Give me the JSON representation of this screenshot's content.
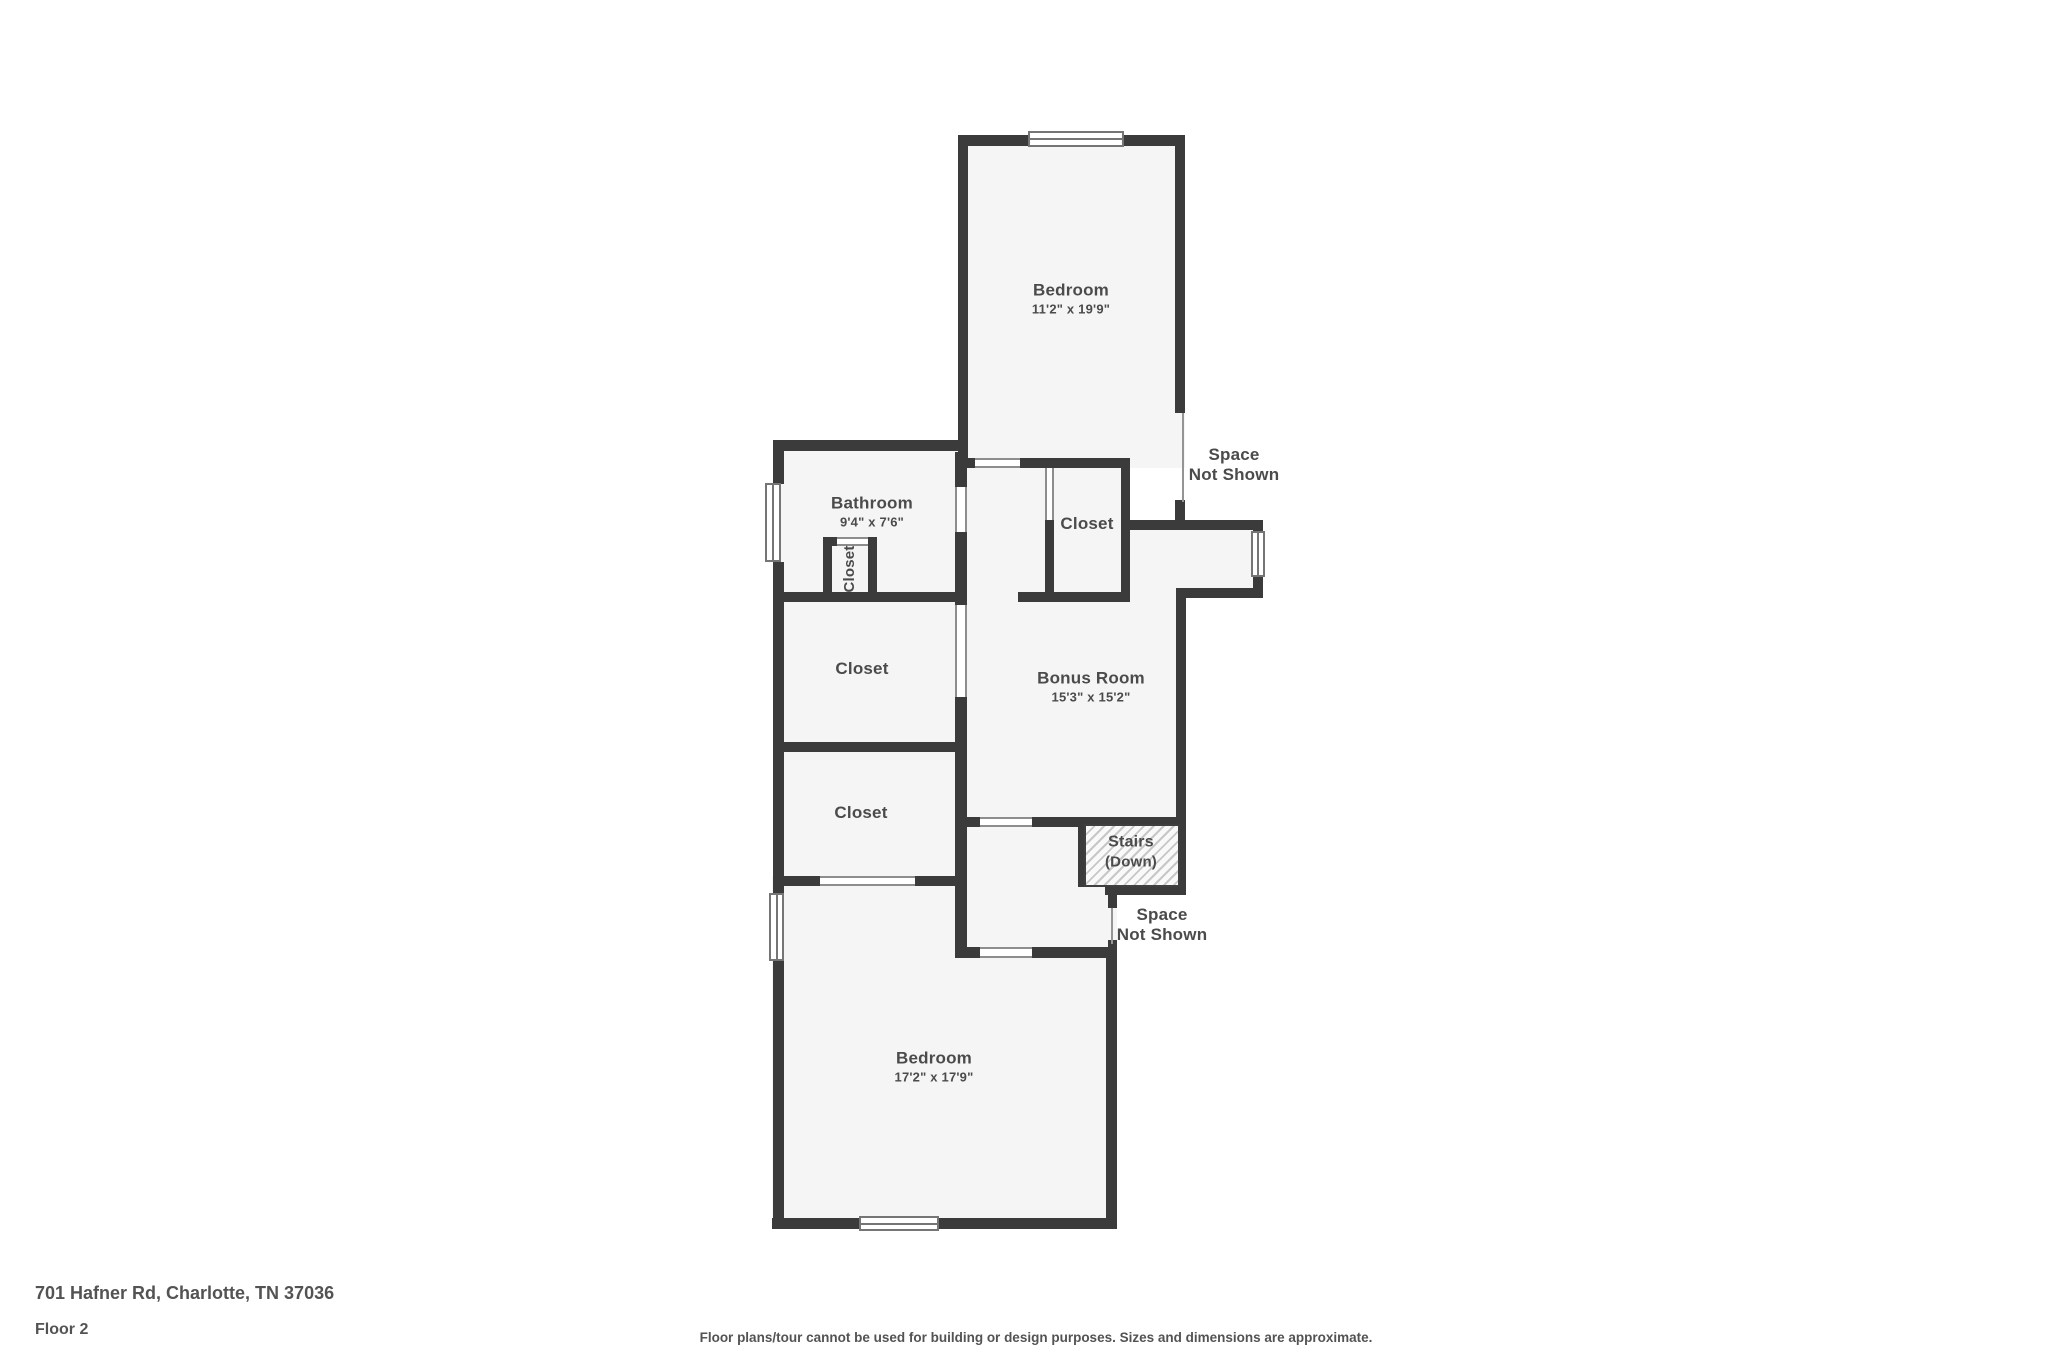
{
  "colors": {
    "wall": "#3b3b3b",
    "floor": "#f5f5f5",
    "text": "#4b4b4b",
    "accent_line": "#8d8d8d"
  },
  "plan": {
    "rooms": {
      "bedroom_top": {
        "name": "Bedroom",
        "dims": "11'2\" x 19'9\""
      },
      "bathroom": {
        "name": "Bathroom",
        "dims": "9'4\" x 7'6\""
      },
      "closet_bathroom": {
        "name": "Closet"
      },
      "closet_right": {
        "name": "Closet"
      },
      "closet_mid": {
        "name": "Closet"
      },
      "closet_low": {
        "name": "Closet"
      },
      "bonus_room": {
        "name": "Bonus Room",
        "dims": "15'3\" x 15'2\""
      },
      "stairs": {
        "name": "Stairs",
        "direction": "(Down)"
      },
      "bedroom_low": {
        "name": "Bedroom",
        "dims": "17'2\" x 17'9\""
      }
    },
    "annotations": {
      "space_not_shown_upper": {
        "line1": "Space",
        "line2": "Not Shown"
      },
      "space_not_shown_lower": {
        "line1": "Space",
        "line2": "Not Shown"
      }
    }
  },
  "footer": {
    "address": "701 Hafner Rd, Charlotte, TN 37036",
    "floor": "Floor 2",
    "disclaimer": "Floor plans/tour cannot be used for building or design purposes. Sizes and dimensions are approximate."
  }
}
